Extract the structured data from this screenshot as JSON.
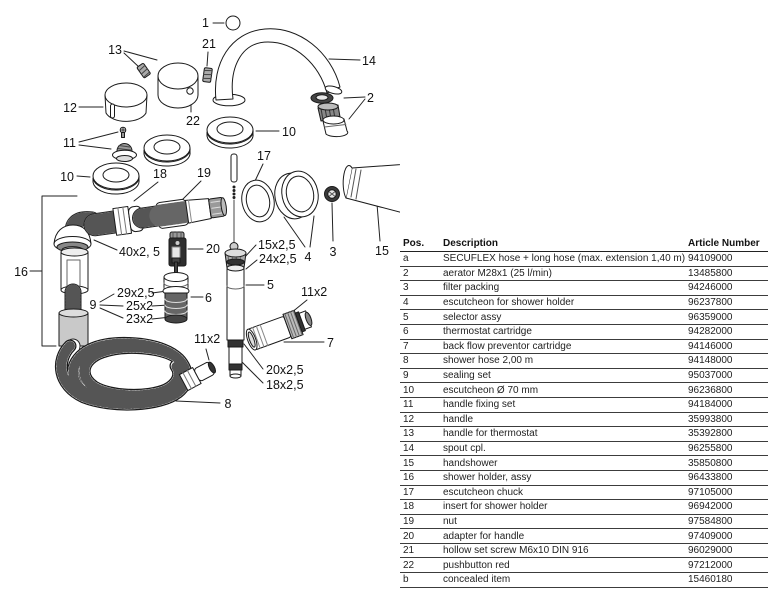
{
  "ink": "#1a1a1a",
  "table_rule_color": "#3c3c3c",
  "diagram": {
    "labels": {
      "l1": "1",
      "l2": "2",
      "l3": "3",
      "l4": "4",
      "l5": "5",
      "l6": "6",
      "l7": "7",
      "l8": "8",
      "l9": "9",
      "l10_left": "10",
      "l10_right": "10",
      "l11": "11",
      "l12": "12",
      "l13": "13",
      "l14": "14",
      "l15": "15",
      "l16": "16",
      "l17": "17",
      "l18": "18",
      "l19": "19",
      "l20": "20",
      "l21": "21",
      "l22": "22",
      "seal_40": "40x2, 5",
      "seal_15": "15x2,5",
      "seal_24": "24x2,5",
      "seal_29": "29x2,5",
      "seal_25": "25x2",
      "seal_23": "23x2",
      "seal_20": "20x2,5",
      "seal_18": "18x2,5",
      "seal_11_upper": "11x2",
      "seal_11_lower": "11x2"
    }
  },
  "table": {
    "headers": {
      "pos": "Pos.",
      "description": "Description",
      "article": "Article Number"
    },
    "rows": [
      {
        "pos": "a",
        "description": "SECUFLEX hose + long hose (max. extension 1,40 m)",
        "article": "94109000"
      },
      {
        "pos": "2",
        "description": "aerator M28x1 (25 l/min)",
        "article": "13485800"
      },
      {
        "pos": "3",
        "description": "filter packing",
        "article": "94246000"
      },
      {
        "pos": "4",
        "description": "escutcheon for shower holder",
        "article": "96237800"
      },
      {
        "pos": "5",
        "description": "selector assy",
        "article": "96359000"
      },
      {
        "pos": "6",
        "description": "thermostat cartridge",
        "article": "94282000"
      },
      {
        "pos": "7",
        "description": "back flow preventor cartridge",
        "article": "94146000"
      },
      {
        "pos": "8",
        "description": "shower hose 2,00 m",
        "article": "94148000"
      },
      {
        "pos": "9",
        "description": "sealing set",
        "article": "95037000"
      },
      {
        "pos": "10",
        "description": "escutcheon Ø 70 mm",
        "article": "96236800"
      },
      {
        "pos": "11",
        "description": "handle fixing set",
        "article": "94184000"
      },
      {
        "pos": "12",
        "description": "handle",
        "article": "35993800"
      },
      {
        "pos": "13",
        "description": "handle for thermostat",
        "article": "35392800"
      },
      {
        "pos": "14",
        "description": "spout cpl.",
        "article": "96255800"
      },
      {
        "pos": "15",
        "description": "handshower",
        "article": "35850800"
      },
      {
        "pos": "16",
        "description": "shower holder, assy",
        "article": "96433800"
      },
      {
        "pos": "17",
        "description": "escutcheon chuck",
        "article": "97105000"
      },
      {
        "pos": "18",
        "description": "insert for shower holder",
        "article": "96942000"
      },
      {
        "pos": "19",
        "description": "nut",
        "article": "97584800"
      },
      {
        "pos": "20",
        "description": "adapter for handle",
        "article": "97409000"
      },
      {
        "pos": "21",
        "description": "hollow set screw M6x10 DIN 916",
        "article": "96029000"
      },
      {
        "pos": "22",
        "description": "pushbutton red",
        "article": "97212000"
      },
      {
        "pos": "b",
        "description": "concealed item",
        "article": "15460180"
      }
    ]
  }
}
